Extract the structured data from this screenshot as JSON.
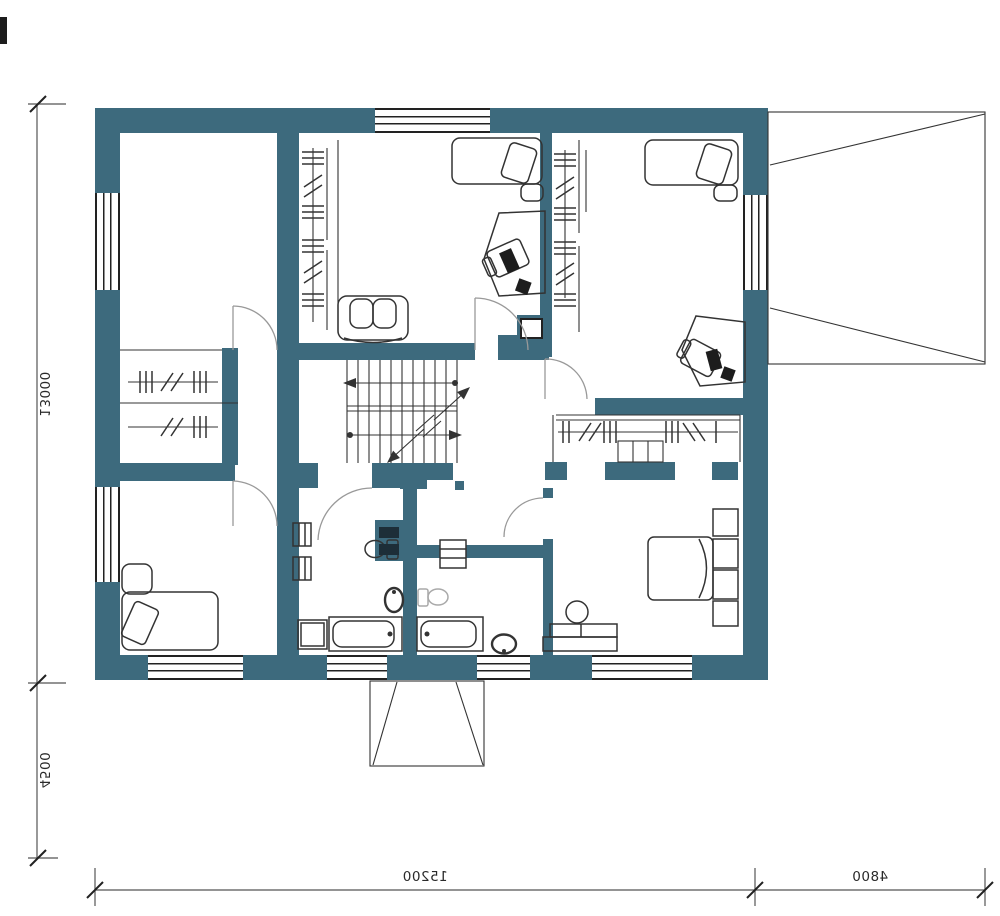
{
  "plan": {
    "dimensions": {
      "height_main": "13000",
      "height_lower": "4500",
      "width_main": "15200",
      "width_right": "4800"
    },
    "colors": {
      "wall": "#3d6a7d",
      "line": "#333333",
      "dim_line": "#555555",
      "fixture_gray": "#a9a9a9"
    }
  }
}
